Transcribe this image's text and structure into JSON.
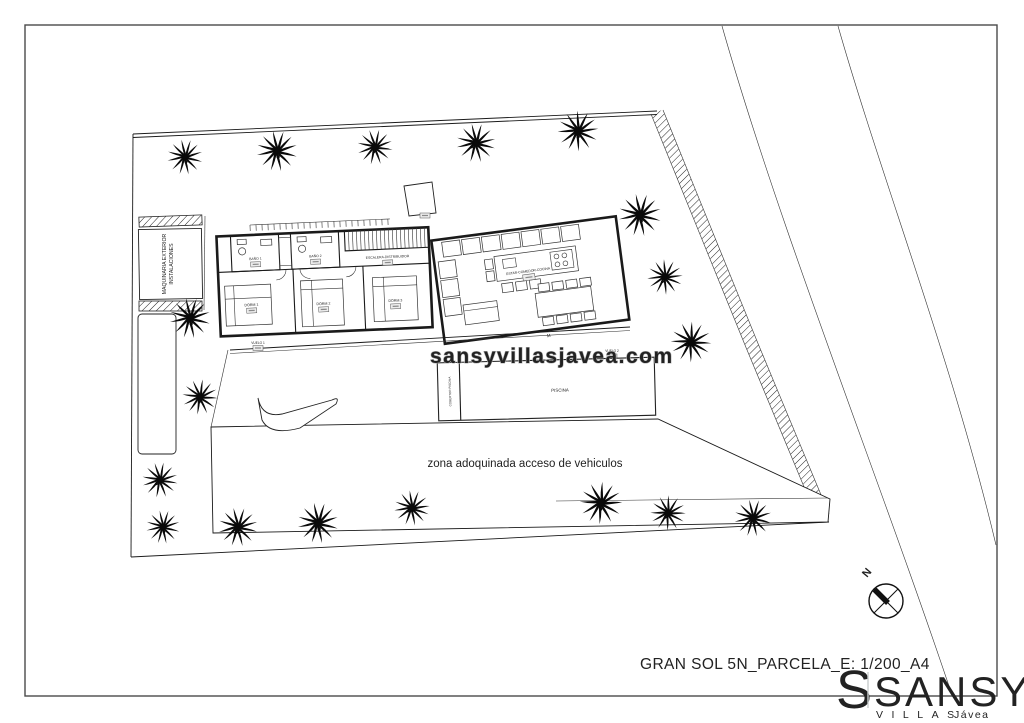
{
  "drawing": {
    "title": "GRAN SOL 5N_PARCELA_E: 1/200_A4",
    "watermark": "sansyvillasjavea.com",
    "paved_zone_label": "zona adoquinada acceso de vehiculos"
  },
  "compass": {
    "north_label": "N"
  },
  "logo": {
    "monogram": "S",
    "brand": "SANSY",
    "tagline": "VILLAS",
    "location": "Jávea",
    "accent_color": "#57a0a2",
    "gray_color": "#c9cdce"
  },
  "site": {
    "machinery_label_line1": "MAQUINARIA EXTERIOR",
    "machinery_label_line2": "INSTALACIONES"
  },
  "rooms": {
    "bath1": "BAÑO 1",
    "bath2": "BAÑO 2",
    "stairs": "ESCALERA-DISTRIBUIDOR",
    "living": "ESTAR-COMEDOR-COCINA",
    "bed1": "DORM 1",
    "bed2": "DORM 2",
    "bed3": "DORM 3",
    "pool": "PISCINA",
    "pool_cover": "COBERTOR PISCINA",
    "overhang1": "VUELO 1",
    "overhang2": "VUELO 2",
    "door_mark": "M"
  }
}
